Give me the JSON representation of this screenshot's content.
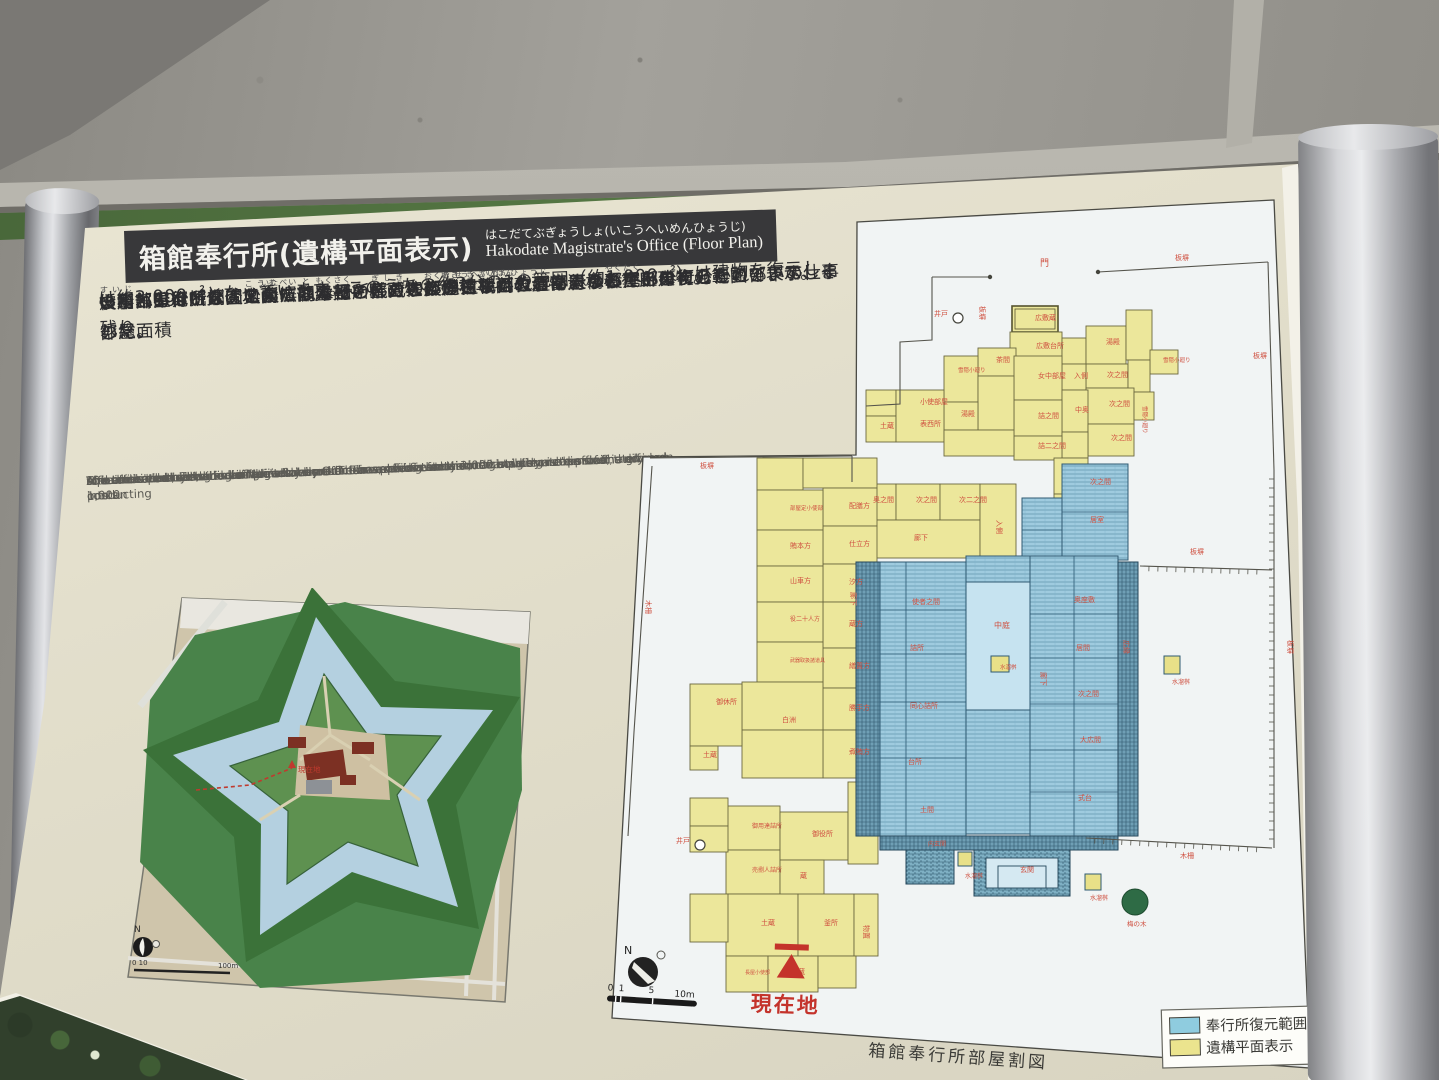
{
  "sign": {
    "title_bar": {
      "title_ja": "箱館奉行所(遺構平面表示)",
      "title_kana": "はこだてぶぎょうしょ(いこうへいめんひょうじ)",
      "title_en": "Hakodate Magistrate's Office (Floor Plan)"
    },
    "body_ja": [
      [
        [
          "　箱館奉行所は、"
        ],
        [
          "公務",
          "こうむ"
        ],
        [
          "を"
        ],
        [
          "執",
          "と"
        ],
        [
          "る役所部分と"
        ],
        [
          "奥向",
          "おくむき"
        ],
        [
          "とよばれる奉行の"
        ],
        [
          "役宅",
          "やくたく"
        ],
        [
          "部分に分かれていて、その総面積"
        ]
      ],
      [
        [
          "は約3,000㎡となっています。このうちの約3分の1の範囲（約1,000㎡）は建物を復元し、残り"
        ]
      ],
      [
        [
          "の約2,000㎡分は地面に部屋割を区画した"
        ],
        [
          "遺構平面表示",
          "いこうへいめんひょうじ"
        ],
        [
          "により奉行所建物の範囲を表示しました。"
        ]
      ],
      [
        [
          "いずれも発掘調査によって発見された柱の"
        ],
        [
          "礎石",
          "そせき"
        ],
        [
          "などの建物遺構の真上に復元しています。"
        ]
      ],
      [
        [
          "役所部分は、玄関・大広間などの"
        ],
        [
          "儀式",
          "ぎしき"
        ],
        [
          "の部屋、"
        ],
        [
          "裁判",
          "さいばん"
        ],
        [
          "などを行う部屋、奉行とその部下の仕事部屋、"
        ]
      ],
      [
        [
          "炊事",
          "すいじ"
        ],
        [
          "部屋などが、奥向には奉行とその家族が住むための部屋などがありました。"
        ]
      ],
      [
        [
          "また、奉行所を囲む"
        ],
        [
          "板塀",
          "いたべい"
        ],
        [
          "や"
        ],
        [
          "木柵",
          "もくさく"
        ],
        [
          "、井戸などの遺構の位置も表示しています。"
        ]
      ]
    ],
    "body_en": [
      "  The total area of Hakodate Magistrate's Office is approximately 3,000 square meters and is divided into an",
      "office area and a residential area \"okumuki\". The area of the restored building is approximately 1,000",
      "square meters, or a third of the total area. The remaining area is indicated by marks on the ground.",
      "The restored building is built directly on the excavated foundation.",
      "The office part of the building includes an entrance and a state room and other rooms for conducting",
      "formal ceremonies, a room for judicial procedures, offices for the magistrate and his staff, and so on.",
      "\"Okumuki\" included magistrate's family rooms.",
      "Also indicated by marks are places where the board fence around the magistrate's office, the fence posts",
      "and the well used to be."
    ]
  },
  "fort_map": {
    "north_label": "N",
    "scale_left": "0 10",
    "scale_right": "100m",
    "current_label": "現在地"
  },
  "floor_plan": {
    "caption": "箱館奉行所部屋割図",
    "compass_label": "N",
    "scale_labels": {
      "l0": "0",
      "l1": "1",
      "l5": "5",
      "l10": "10m"
    },
    "current_label": "現在地",
    "legend": [
      {
        "label": "奉行所復元範囲",
        "color": "#8fccdf"
      },
      {
        "label": "遺構平面表示",
        "color": "#ebe48e"
      }
    ],
    "paper": "857,222 1274,200 1310,1068 612,1018 643,457 856,455",
    "rooms": [
      [
        1012,
        306,
        46,
        26,
        "s"
      ],
      [
        1010,
        332,
        52,
        28,
        "y"
      ],
      [
        1062,
        338,
        24,
        26,
        "y"
      ],
      [
        1086,
        326,
        40,
        38,
        "y"
      ],
      [
        1126,
        310,
        26,
        50,
        "y"
      ],
      [
        1086,
        364,
        42,
        24,
        "y"
      ],
      [
        1062,
        364,
        24,
        26,
        "y"
      ],
      [
        1150,
        350,
        28,
        24,
        "y"
      ],
      [
        1128,
        360,
        22,
        32,
        "y"
      ],
      [
        1086,
        388,
        48,
        36,
        "y"
      ],
      [
        1134,
        392,
        20,
        28,
        "y"
      ],
      [
        978,
        348,
        38,
        28,
        "y"
      ],
      [
        944,
        356,
        34,
        46,
        "y"
      ],
      [
        1014,
        356,
        48,
        44,
        "y"
      ],
      [
        1062,
        390,
        26,
        42,
        "y"
      ],
      [
        1014,
        400,
        48,
        36,
        "y"
      ],
      [
        978,
        376,
        36,
        54,
        "y"
      ],
      [
        944,
        402,
        34,
        28,
        "y"
      ],
      [
        1088,
        424,
        46,
        32,
        "y"
      ],
      [
        1062,
        432,
        26,
        26,
        "y"
      ],
      [
        1014,
        436,
        48,
        24,
        "y"
      ],
      [
        866,
        390,
        30,
        26,
        "y"
      ],
      [
        866,
        416,
        30,
        26,
        "y"
      ],
      [
        896,
        390,
        48,
        52,
        "y"
      ],
      [
        944,
        430,
        70,
        26,
        "y"
      ],
      [
        1054,
        458,
        34,
        36,
        "y"
      ],
      [
        1054,
        494,
        34,
        34,
        "y"
      ],
      [
        852,
        484,
        44,
        36,
        "y"
      ],
      [
        896,
        484,
        44,
        36,
        "y"
      ],
      [
        940,
        484,
        40,
        36,
        "y"
      ],
      [
        852,
        520,
        128,
        38,
        "y"
      ],
      [
        980,
        484,
        36,
        74,
        "y"
      ],
      [
        757,
        458,
        46,
        32,
        "y"
      ],
      [
        803,
        458,
        74,
        30,
        "y"
      ],
      [
        823,
        488,
        54,
        38,
        "y"
      ],
      [
        823,
        526,
        54,
        38,
        "y"
      ],
      [
        823,
        564,
        54,
        38,
        "y"
      ],
      [
        823,
        602,
        54,
        46,
        "y"
      ],
      [
        823,
        648,
        54,
        40,
        "y"
      ],
      [
        823,
        688,
        54,
        42,
        "y"
      ],
      [
        823,
        730,
        54,
        48,
        "y"
      ],
      [
        757,
        490,
        66,
        40,
        "y"
      ],
      [
        757,
        530,
        66,
        36,
        "y"
      ],
      [
        757,
        566,
        66,
        36,
        "y"
      ],
      [
        757,
        602,
        66,
        40,
        "y"
      ],
      [
        757,
        642,
        66,
        40,
        "y"
      ],
      [
        742,
        682,
        81,
        48,
        "y"
      ],
      [
        742,
        730,
        81,
        48,
        "y"
      ],
      [
        690,
        684,
        52,
        62,
        "y"
      ],
      [
        690,
        746,
        28,
        24,
        "y"
      ],
      [
        726,
        806,
        54,
        44,
        "y"
      ],
      [
        726,
        850,
        54,
        44,
        "y"
      ],
      [
        690,
        798,
        38,
        28,
        "y"
      ],
      [
        690,
        826,
        38,
        26,
        "y"
      ],
      [
        780,
        812,
        68,
        48,
        "y"
      ],
      [
        780,
        860,
        44,
        36,
        "y"
      ],
      [
        726,
        894,
        72,
        62,
        "y"
      ],
      [
        690,
        894,
        38,
        48,
        "y"
      ],
      [
        798,
        894,
        56,
        62,
        "y"
      ],
      [
        854,
        894,
        24,
        62,
        "y"
      ],
      [
        726,
        956,
        42,
        36,
        "y"
      ],
      [
        768,
        956,
        50,
        36,
        "y"
      ],
      [
        818,
        956,
        38,
        32,
        "y"
      ],
      [
        848,
        782,
        30,
        82,
        "y"
      ],
      [
        1022,
        498,
        40,
        64,
        "h"
      ],
      [
        1062,
        464,
        66,
        96,
        "h"
      ],
      [
        856,
        562,
        24,
        274,
        "e"
      ],
      [
        880,
        562,
        86,
        274,
        "h"
      ],
      [
        966,
        556,
        64,
        26,
        "h"
      ],
      [
        966,
        582,
        64,
        128,
        "c"
      ],
      [
        966,
        710,
        64,
        124,
        "h"
      ],
      [
        1030,
        556,
        88,
        280,
        "h"
      ],
      [
        1118,
        562,
        20,
        274,
        "e"
      ],
      [
        880,
        836,
        238,
        14,
        "e"
      ],
      [
        906,
        850,
        48,
        34,
        "g"
      ],
      [
        974,
        850,
        96,
        46,
        "g"
      ],
      [
        991,
        656,
        18,
        16,
        "b"
      ],
      [
        1164,
        656,
        16,
        18,
        "b"
      ],
      [
        958,
        852,
        14,
        14,
        "b"
      ],
      [
        1085,
        874,
        16,
        16,
        "b"
      ]
    ],
    "steps": [
      [
        986,
        858,
        72,
        30
      ],
      [
        998,
        866,
        48,
        22
      ]
    ],
    "blue_lines": [
      "M880,610 H966",
      "M880,654 H966",
      "M880,702 H966",
      "M880,758 H966",
      "M906,562 V836",
      "M1030,614 H1118",
      "M1030,658 H1118",
      "M1030,704 H1118",
      "M1030,750 H1118",
      "M1030,792 H1118",
      "M1074,556 V836",
      "M1062,512 H1128",
      "M1022,530 H1062"
    ],
    "fences": [
      "M650,458 L852,456",
      "M652,466 L634,732 L628,836",
      "M852,456 L852,482",
      "M932,277 L990,277",
      "M1098,272 L1268,262",
      "M932,277 L932,340 L900,342 L900,404 L866,406",
      "M1268,262 L1274,470"
    ],
    "ticked": [
      [
        1274,
        470,
        1274,
        848
      ],
      [
        1140,
        566,
        1272,
        570
      ],
      [
        1086,
        838,
        1272,
        848
      ]
    ],
    "dots": [
      [
        990,
        277
      ],
      [
        1098,
        272
      ]
    ],
    "wells": [
      [
        958,
        318
      ],
      [
        700,
        845
      ]
    ],
    "tree": {
      "x": 1135,
      "y": 902,
      "r": 13,
      "label": "梅の木"
    },
    "labels": [
      [
        "門",
        1040,
        266,
        0,
        9
      ],
      [
        "井戸",
        934,
        316
      ],
      [
        "井戸",
        676,
        843
      ],
      [
        "板塀",
        700,
        468
      ],
      [
        "木柵",
        646,
        600,
        90
      ],
      [
        "板塀",
        980,
        306,
        90
      ],
      [
        "板塀",
        1175,
        260
      ],
      [
        "板塀",
        1253,
        358
      ],
      [
        "板塀",
        1190,
        554
      ],
      [
        "板塀",
        1288,
        640,
        90
      ],
      [
        "木柵",
        1180,
        858
      ],
      [
        "広敷蔵",
        1035,
        320
      ],
      [
        "広敷台所",
        1036,
        348
      ],
      [
        "湯殿",
        1106,
        344
      ],
      [
        "入側",
        1074,
        378
      ],
      [
        "次之間",
        1107,
        377
      ],
      [
        "次之間",
        1109,
        406
      ],
      [
        "次之間",
        1111,
        440
      ],
      [
        "女中部屋",
        1038,
        378
      ],
      [
        "詰之間",
        1038,
        418
      ],
      [
        "詰二之間",
        1038,
        448
      ],
      [
        "中奥",
        1075,
        412
      ],
      [
        "雪隠小廻り",
        1163,
        362,
        0,
        5.5
      ],
      [
        "雪隠小廻り",
        1143,
        406,
        90,
        5.5
      ],
      [
        "雪隠小廻り",
        958,
        372,
        0,
        5.5
      ],
      [
        "土蔵",
        880,
        428
      ],
      [
        "小使部屋",
        920,
        404
      ],
      [
        "表西所",
        920,
        426
      ],
      [
        "茶間",
        996,
        362
      ],
      [
        "湯殿",
        961,
        416
      ],
      [
        "奥之間",
        873,
        502
      ],
      [
        "次之間",
        916,
        502
      ],
      [
        "次二之間",
        959,
        502
      ],
      [
        "廊下",
        914,
        540
      ],
      [
        "入側",
        997,
        520,
        90
      ],
      [
        "部屋定小使部",
        790,
        510,
        0,
        5.5
      ],
      [
        "賄本方",
        790,
        548
      ],
      [
        "山車方",
        790,
        583
      ],
      [
        "役二十人方",
        790,
        621,
        0,
        6
      ],
      [
        "武器取扱諸道具",
        790,
        662,
        0,
        5
      ],
      [
        "御休所",
        716,
        704
      ],
      [
        "白洲",
        782,
        722
      ],
      [
        "土蔵",
        703,
        757
      ],
      [
        "廊下",
        851,
        592,
        90
      ],
      [
        "配膳方",
        849,
        508
      ],
      [
        "仕立方",
        849,
        546
      ],
      [
        "汐方",
        849,
        584
      ],
      [
        "蔵方",
        849,
        626
      ],
      [
        "繕置方",
        849,
        668
      ],
      [
        "勝手方",
        849,
        710
      ],
      [
        "煮賄方",
        849,
        754
      ],
      [
        "御用達詰所",
        752,
        828,
        0,
        6
      ],
      [
        "売捌人詰所",
        752,
        872,
        0,
        6
      ],
      [
        "御役所",
        812,
        836
      ],
      [
        "蔵",
        800,
        878
      ],
      [
        "土蔵",
        761,
        925
      ],
      [
        "釜所",
        824,
        925
      ],
      [
        "物置",
        864,
        925,
        90
      ],
      [
        "土蔵",
        791,
        974
      ],
      [
        "長屋小使部",
        745,
        974,
        0,
        5
      ],
      [
        "使者之間",
        912,
        604
      ],
      [
        "詰所",
        910,
        650
      ],
      [
        "同心詰所",
        910,
        708
      ],
      [
        "台所",
        908,
        764
      ],
      [
        "土間",
        920,
        812
      ],
      [
        "奥座敷",
        1074,
        602
      ],
      [
        "居間",
        1076,
        650
      ],
      [
        "次之間",
        1078,
        696
      ],
      [
        "大広間",
        1080,
        742
      ],
      [
        "式台",
        1078,
        800
      ],
      [
        "中庭",
        994,
        628,
        0,
        8
      ],
      [
        "水溜桝",
        1000,
        669,
        0,
        5.5
      ],
      [
        "広縁",
        1124,
        640,
        90
      ],
      [
        "廊下",
        1041,
        672,
        90
      ],
      [
        "次之間",
        1090,
        484
      ],
      [
        "居室",
        1090,
        522
      ],
      [
        "内玄関",
        928,
        846,
        0,
        6
      ],
      [
        "玄関",
        1020,
        872
      ],
      [
        "水溜桝",
        965,
        878,
        0,
        6
      ],
      [
        "水溜桝",
        1090,
        900,
        0,
        6
      ],
      [
        "水溜桝",
        1172,
        684,
        0,
        6
      ]
    ]
  }
}
